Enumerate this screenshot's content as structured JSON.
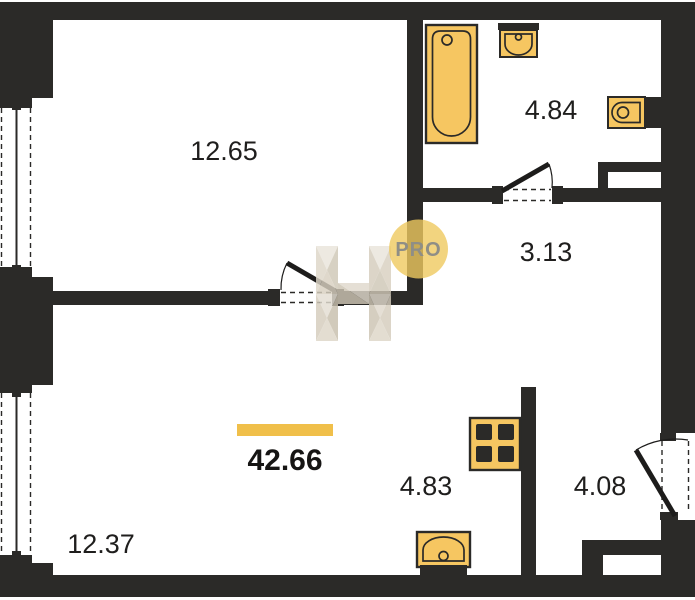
{
  "plan_type": "apartment-floor-plan",
  "total": {
    "area": "42.66"
  },
  "rooms": {
    "living": {
      "area": "12.65"
    },
    "bathroom": {
      "area": "4.84"
    },
    "hall": {
      "area": "3.13"
    },
    "kitchen": {
      "area": "4.83"
    },
    "entry": {
      "area": "4.08"
    },
    "bedroom": {
      "area": "12.37"
    }
  },
  "watermark": {
    "badge": "PRO"
  },
  "fixtures": [
    "bathtub",
    "bathroom-sink",
    "toilet",
    "stove",
    "kitchen-sink"
  ],
  "colors": {
    "background": "#FFFFFF",
    "wall": "#2b2a28",
    "fixture_fill": "#F6C661",
    "fixture_outline": "#2b2a28",
    "accent_bar": "#F0BF4A",
    "pro_badge_bg": "#EFC95F",
    "pro_badge_text": "#8F8E86",
    "watermark_beige": "#D8D0C0"
  }
}
